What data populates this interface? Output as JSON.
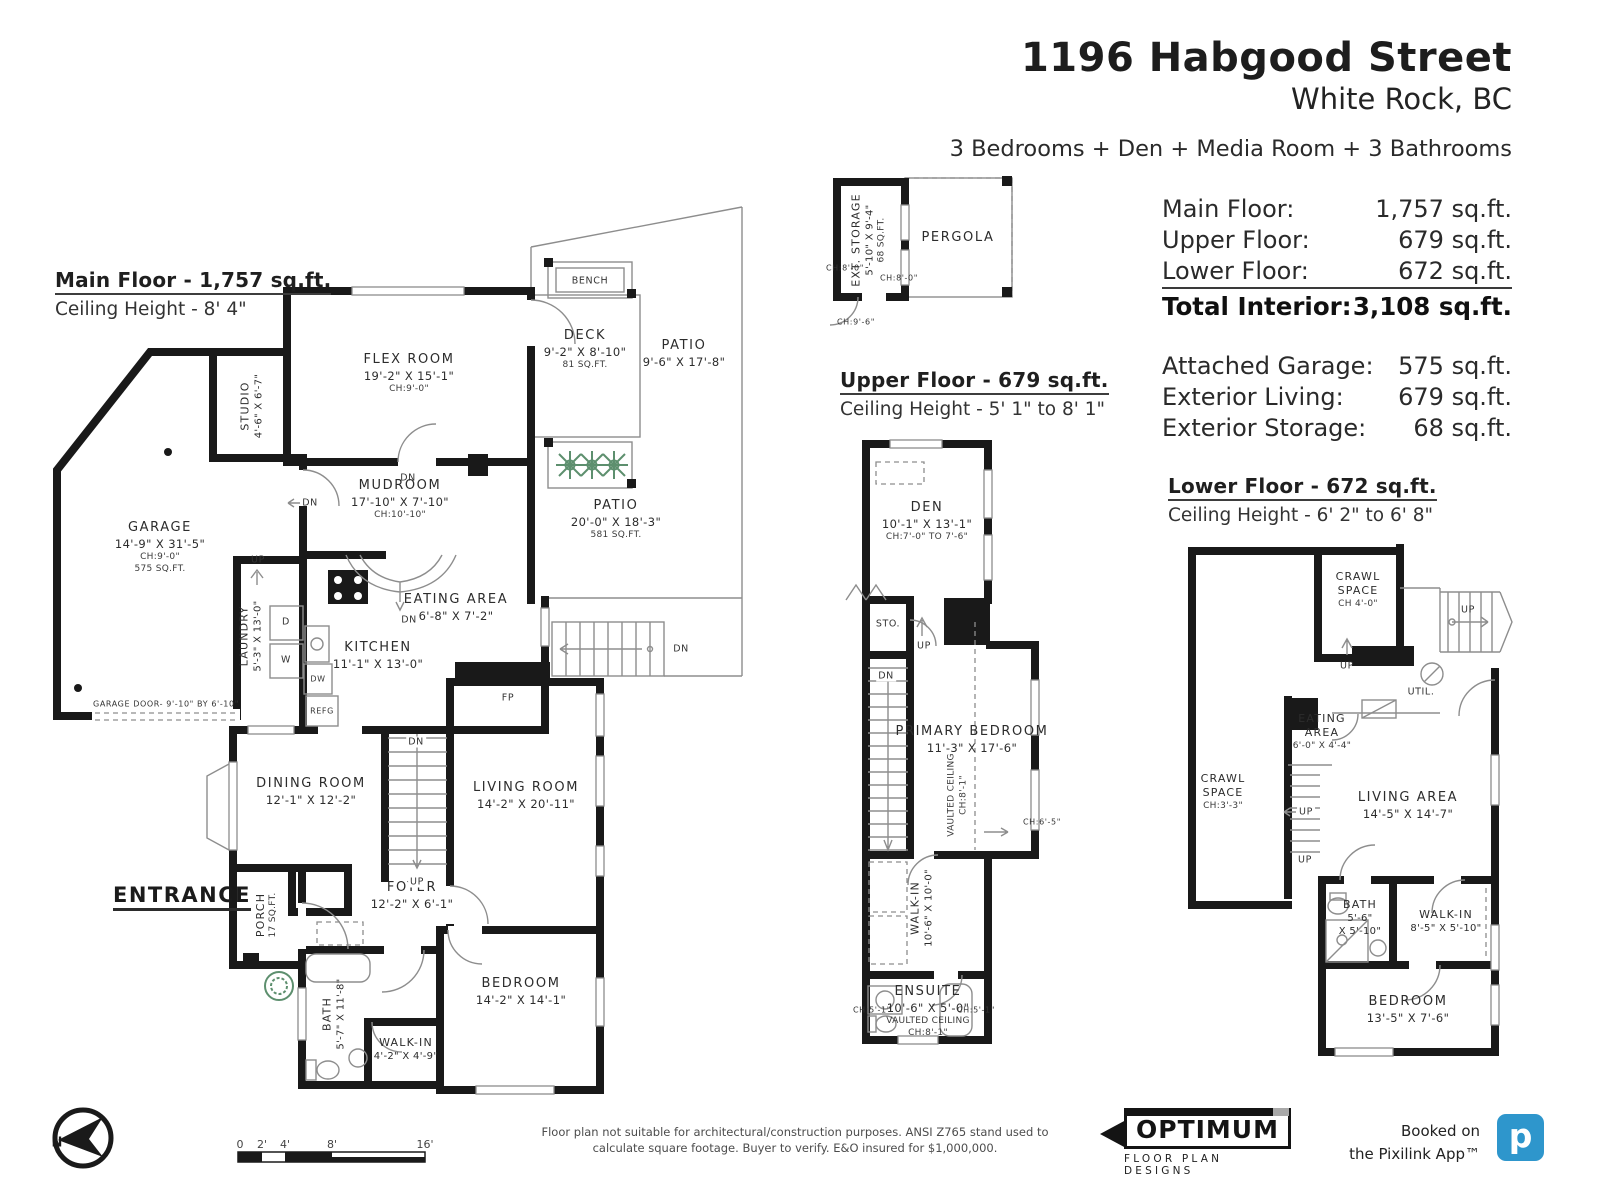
{
  "header": {
    "address": "1196 Habgood Street",
    "city": "White Rock, BC",
    "summary": "3 Bedrooms + Den + Media Room + 3 Bathrooms"
  },
  "area_table": {
    "rows": [
      {
        "label": "Main Floor:",
        "value": "1,757 sq.ft."
      },
      {
        "label": "Upper Floor:",
        "value": "679 sq.ft."
      },
      {
        "label": "Lower Floor:",
        "value": "672 sq.ft."
      },
      {
        "label": "Total Interior:",
        "value": "3,108 sq.ft."
      }
    ],
    "exterior_rows": [
      {
        "label": "Attached Garage:",
        "value": "575 sq.ft."
      },
      {
        "label": "Exterior Living:",
        "value": "679 sq.ft."
      },
      {
        "label": "Exterior Storage:",
        "value": "68 sq.ft."
      }
    ]
  },
  "main_floor": {
    "title": "Main Floor - 1,757 sq.ft.",
    "ceiling": "Ceiling Height - 8' 4\"",
    "rooms": {
      "flex": {
        "name": "FLEX ROOM",
        "dims": "19'-2\" X 15'-1\"",
        "note": "CH:9'-0\""
      },
      "studio": {
        "name": "STUDIO",
        "dims": "4'-6\" X 6'-7\""
      },
      "deck": {
        "name": "DECK",
        "dims": "9'-2\" X 8'-10\"",
        "area": "81 SQ.FT."
      },
      "patio_upper": {
        "name": "PATIO",
        "dims": "9'-6\" X 17'-8\""
      },
      "patio_lower": {
        "name": "PATIO",
        "dims": "20'-0\" X 18'-3\"",
        "area": "581 SQ.FT."
      },
      "mudroom": {
        "name": "MUDROOM",
        "dims": "17'-10\" X 7'-10\"",
        "note": "CH:10'-10\""
      },
      "garage": {
        "name": "GARAGE",
        "dims": "14'-9\" X 31'-5\"",
        "note": "CH:9'-0\"",
        "area": "575 SQ.FT."
      },
      "laundry": {
        "name": "LAUNDRY",
        "dims": "5'-3\" X 13'-0\""
      },
      "eating": {
        "name": "EATING AREA",
        "dims": "6'-8\" X 7'-2\""
      },
      "kitchen": {
        "name": "KITCHEN",
        "dims": "11'-1\" X 13'-0\""
      },
      "dining": {
        "name": "DINING ROOM",
        "dims": "12'-1\" X 12'-2\""
      },
      "living": {
        "name": "LIVING ROOM",
        "dims": "14'-2\" X 20'-11\""
      },
      "foyer": {
        "name": "FOYER",
        "dims": "12'-2\" X 6'-1\""
      },
      "porch": {
        "name": "PORCH",
        "area": "17 SQ.FT."
      },
      "bath": {
        "name": "BATH",
        "dims": "5'-7\" X 11'-8\""
      },
      "walk_in": {
        "name": "WALK-IN",
        "dims": "4'-2\" X 4'-9\""
      },
      "bedroom": {
        "name": "BEDROOM",
        "dims": "14'-2\" X 14'-1\""
      }
    }
  },
  "upper_floor": {
    "title": "Upper Floor - 679 sq.ft.",
    "ceiling": "Ceiling Height - 5' 1\" to 8' 1\"",
    "rooms": {
      "ext_storage": {
        "name": "EXT. STORAGE",
        "dims": "5'-10\" X 9'-4\"",
        "area": "68 SQ.FT.",
        "ch_left": "CH:8'-0\"",
        "ch_right": "CH:8'-0\"",
        "ch_door": "CH:9'-6\""
      },
      "pergola": {
        "name": "PERGOLA"
      },
      "den": {
        "name": "DEN",
        "dims": "10'-1\" X 13'-1\"",
        "note": "CH:7'-0\" TO 7'-6\""
      },
      "primary": {
        "name": "PRIMARY BEDROOM",
        "dims": "11'-3\" X 17'-6\"",
        "vaulted": "VAULTED CEILING",
        "ch": "CH:8'-1\"",
        "ch_side": "CH:6'-5\""
      },
      "walk_in": {
        "name": "WALK-IN",
        "dims": "10'-6\" X 10'-0\""
      },
      "ensuite": {
        "name": "ENSUITE",
        "dims": "10'-6\" X 5'-0\"",
        "vaulted": "VAULTED CEILING",
        "ch": "CH:8'-1\"",
        "ch_left": "CH:5'-1\"",
        "ch_right": "CH:5'-1\""
      }
    }
  },
  "lower_floor": {
    "title": "Lower Floor - 672 sq.ft.",
    "ceiling": "Ceiling Height - 6' 2\" to 6' 8\"",
    "rooms": {
      "crawl_upper": {
        "name": "CRAWL SPACE",
        "note": "CH 4'-0\""
      },
      "crawl_left": {
        "name": "CRAWL SPACE",
        "note": "CH:3'-3\""
      },
      "eating": {
        "name": "EATING AREA",
        "dims": "6'-0\" X 4'-4\""
      },
      "living": {
        "name": "LIVING AREA",
        "dims": "14'-5\" X 14'-7\""
      },
      "bath": {
        "name": "BATH",
        "dims1": "5'-6\"",
        "dims2": "X 5'-10\""
      },
      "walk_in": {
        "name": "WALK-IN",
        "dims": "8'-5\" X 5'-10\""
      },
      "bedroom": {
        "name": "BEDROOM",
        "dims": "13'-5\" X 7'-6\""
      }
    }
  },
  "misc": {
    "up": "UP",
    "dn": "DN",
    "sto": "STO.",
    "util": "UTIL.",
    "bench": "BENCH",
    "fp": "FP",
    "d": "D",
    "w": "W",
    "dw": "DW",
    "refg": "REFG",
    "entrance": "ENTRANCE",
    "garage_door": "GARAGE DOOR- 9'-10\" BY 6'-10\"",
    "north": "N"
  },
  "scale_bar": {
    "labels": [
      "0",
      "2'",
      "4'",
      "8'",
      "16'"
    ]
  },
  "footer": {
    "disclaimer1": "Floor plan not suitable for architectural/construction purposes. ANSI Z765 stand used to",
    "disclaimer2": "calculate square footage. Buyer to verify.  E&O insured for $1,000,000.",
    "optimum_name": "OPTIMUM",
    "optimum_sub": "FLOOR PLAN DESIGNS",
    "booked1": "Booked on",
    "booked2": "the Pixilink App™",
    "pixilink_letter": "p",
    "pixilink_color": "#2e96cc",
    "wall_color": "#191919",
    "plant_color": "#5d8f6e"
  }
}
